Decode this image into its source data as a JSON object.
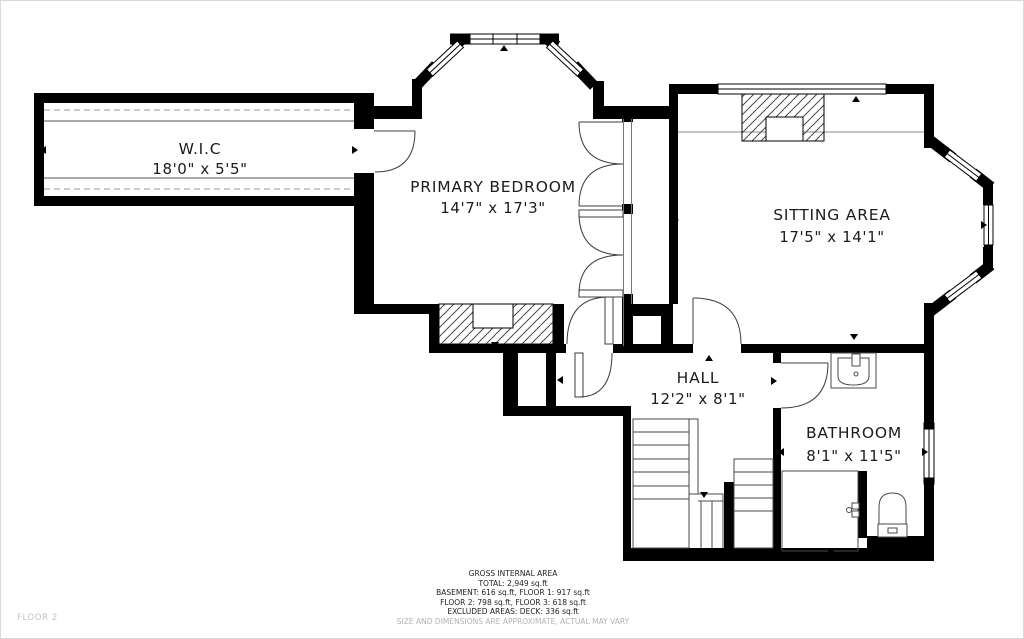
{
  "meta": {
    "floor_label": "FLOOR 2"
  },
  "rooms": [
    {
      "id": "wic",
      "name": "W.I.C",
      "dims": "18'0\" x 5'5\""
    },
    {
      "id": "primary-bedroom",
      "name": "PRIMARY BEDROOM",
      "dims": "14'7\" x 17'3\""
    },
    {
      "id": "sitting-area",
      "name": "SITTING AREA",
      "dims": "17'5\" x 14'1\""
    },
    {
      "id": "hall",
      "name": "HALL",
      "dims": "12'2\" x 8'1\""
    },
    {
      "id": "bathroom",
      "name": "BATHROOM",
      "dims": "8'1\" x 11'5\""
    }
  ],
  "footer": {
    "title": "GROSS INTERNAL AREA",
    "total": "TOTAL: 2,949 sq.ft",
    "line1": "BASEMENT: 616 sq.ft, FLOOR 1: 917 sq.ft",
    "line2": "FLOOR 2: 798 sq.ft, FLOOR 3: 618 sq.ft",
    "line3": "EXCLUDED AREAS: DECK: 336 sq.ft",
    "disclaimer": "SIZE AND DIMENSIONS ARE APPROXIMATE, ACTUAL MAY VARY"
  },
  "colors": {
    "wall": "#000000",
    "text": "#1c1c1c",
    "muted": "#b3b3b3"
  }
}
